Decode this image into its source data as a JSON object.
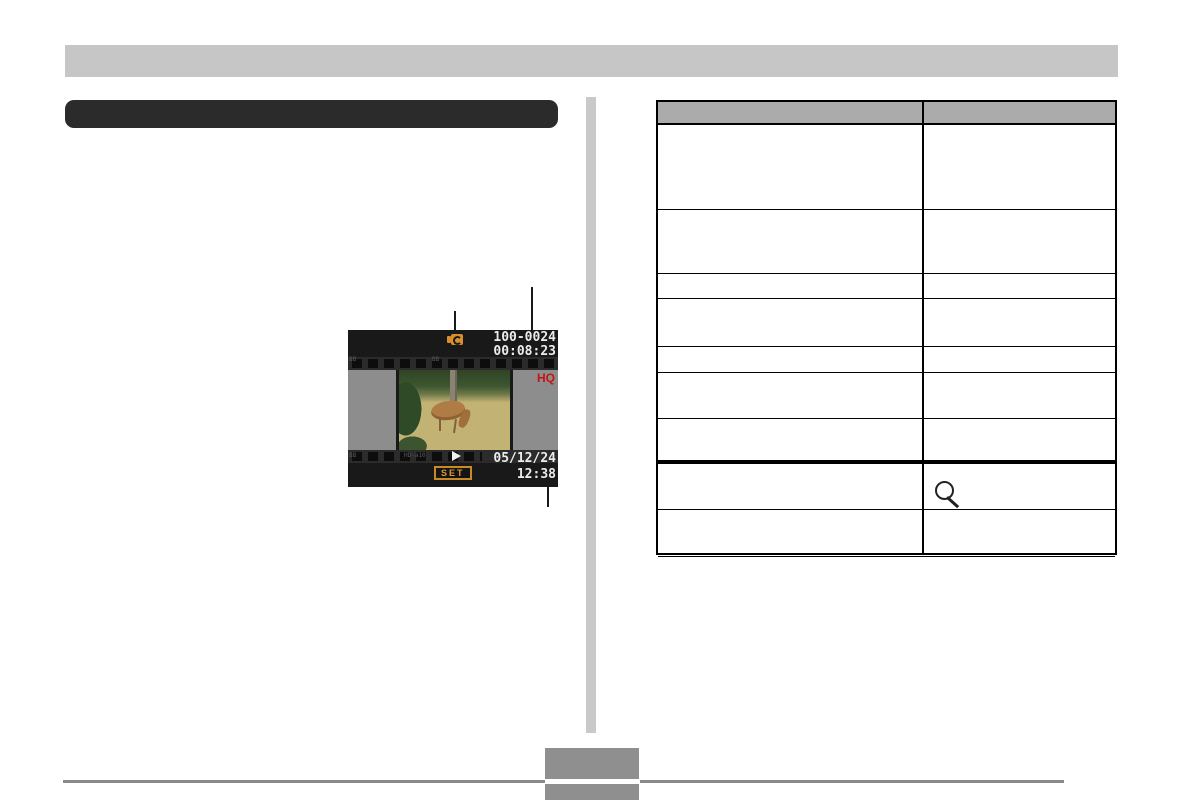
{
  "document": {
    "type": "camera-manual-page",
    "colors": {
      "top_bar_gray": "#c6c6c6",
      "title_bar_black": "#2b2b2b",
      "table_header_gray": "#ababab",
      "divider_gray": "#c9c9c9",
      "footer_gray": "#8f8f8f",
      "accent_orange": "#d98f2b",
      "hq_red": "#c41414",
      "screen_background": "#191919"
    }
  },
  "camera_screen": {
    "file_number": "100-0024",
    "elapsed_time": "00:08:23",
    "quality_indicator": "HQ",
    "date": "05/12/24",
    "clock": "12:38",
    "set_button_label": "SET",
    "film_edge_marks": {
      "top_left": "BB",
      "top_mid": "BB",
      "bottom_left": "BB",
      "bottom_mid": "HD-a10"
    }
  },
  "table": {
    "columns": 2,
    "header": [
      "",
      ""
    ],
    "rows": [
      [
        "",
        ""
      ],
      [
        "",
        ""
      ],
      [
        "",
        ""
      ],
      [
        "",
        ""
      ],
      [
        "",
        ""
      ],
      [
        "",
        ""
      ],
      [
        "",
        ""
      ],
      [
        "",
        "magnifier-icon"
      ],
      [
        "",
        ""
      ]
    ]
  }
}
